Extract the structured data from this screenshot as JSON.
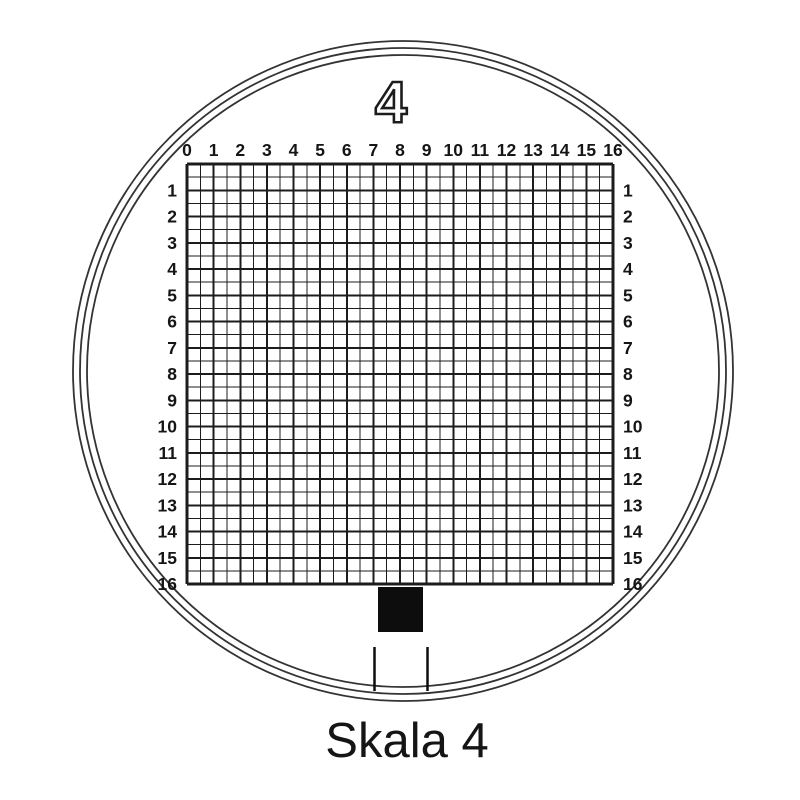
{
  "reticle": {
    "scale_number": "4",
    "caption": "Skala 4",
    "grid": {
      "units": 16,
      "subdivisions_per_unit": 2,
      "top_labels": [
        "0",
        "1",
        "2",
        "3",
        "4",
        "5",
        "6",
        "7",
        "8",
        "9",
        "10",
        "11",
        "12",
        "13",
        "14",
        "15",
        "16"
      ],
      "left_labels": [
        "1",
        "2",
        "3",
        "4",
        "5",
        "6",
        "7",
        "8",
        "9",
        "10",
        "11",
        "12",
        "13",
        "14",
        "15",
        "16"
      ],
      "right_labels": [
        "1",
        "2",
        "3",
        "4",
        "5",
        "6",
        "7",
        "8",
        "9",
        "10",
        "11",
        "12",
        "13",
        "14",
        "15",
        "16"
      ]
    },
    "colors": {
      "background": "#ffffff",
      "grid_line": "#1c1c1c",
      "ring": "#333333",
      "text": "#151515",
      "marker_fill": "#0d0d0d"
    }
  }
}
